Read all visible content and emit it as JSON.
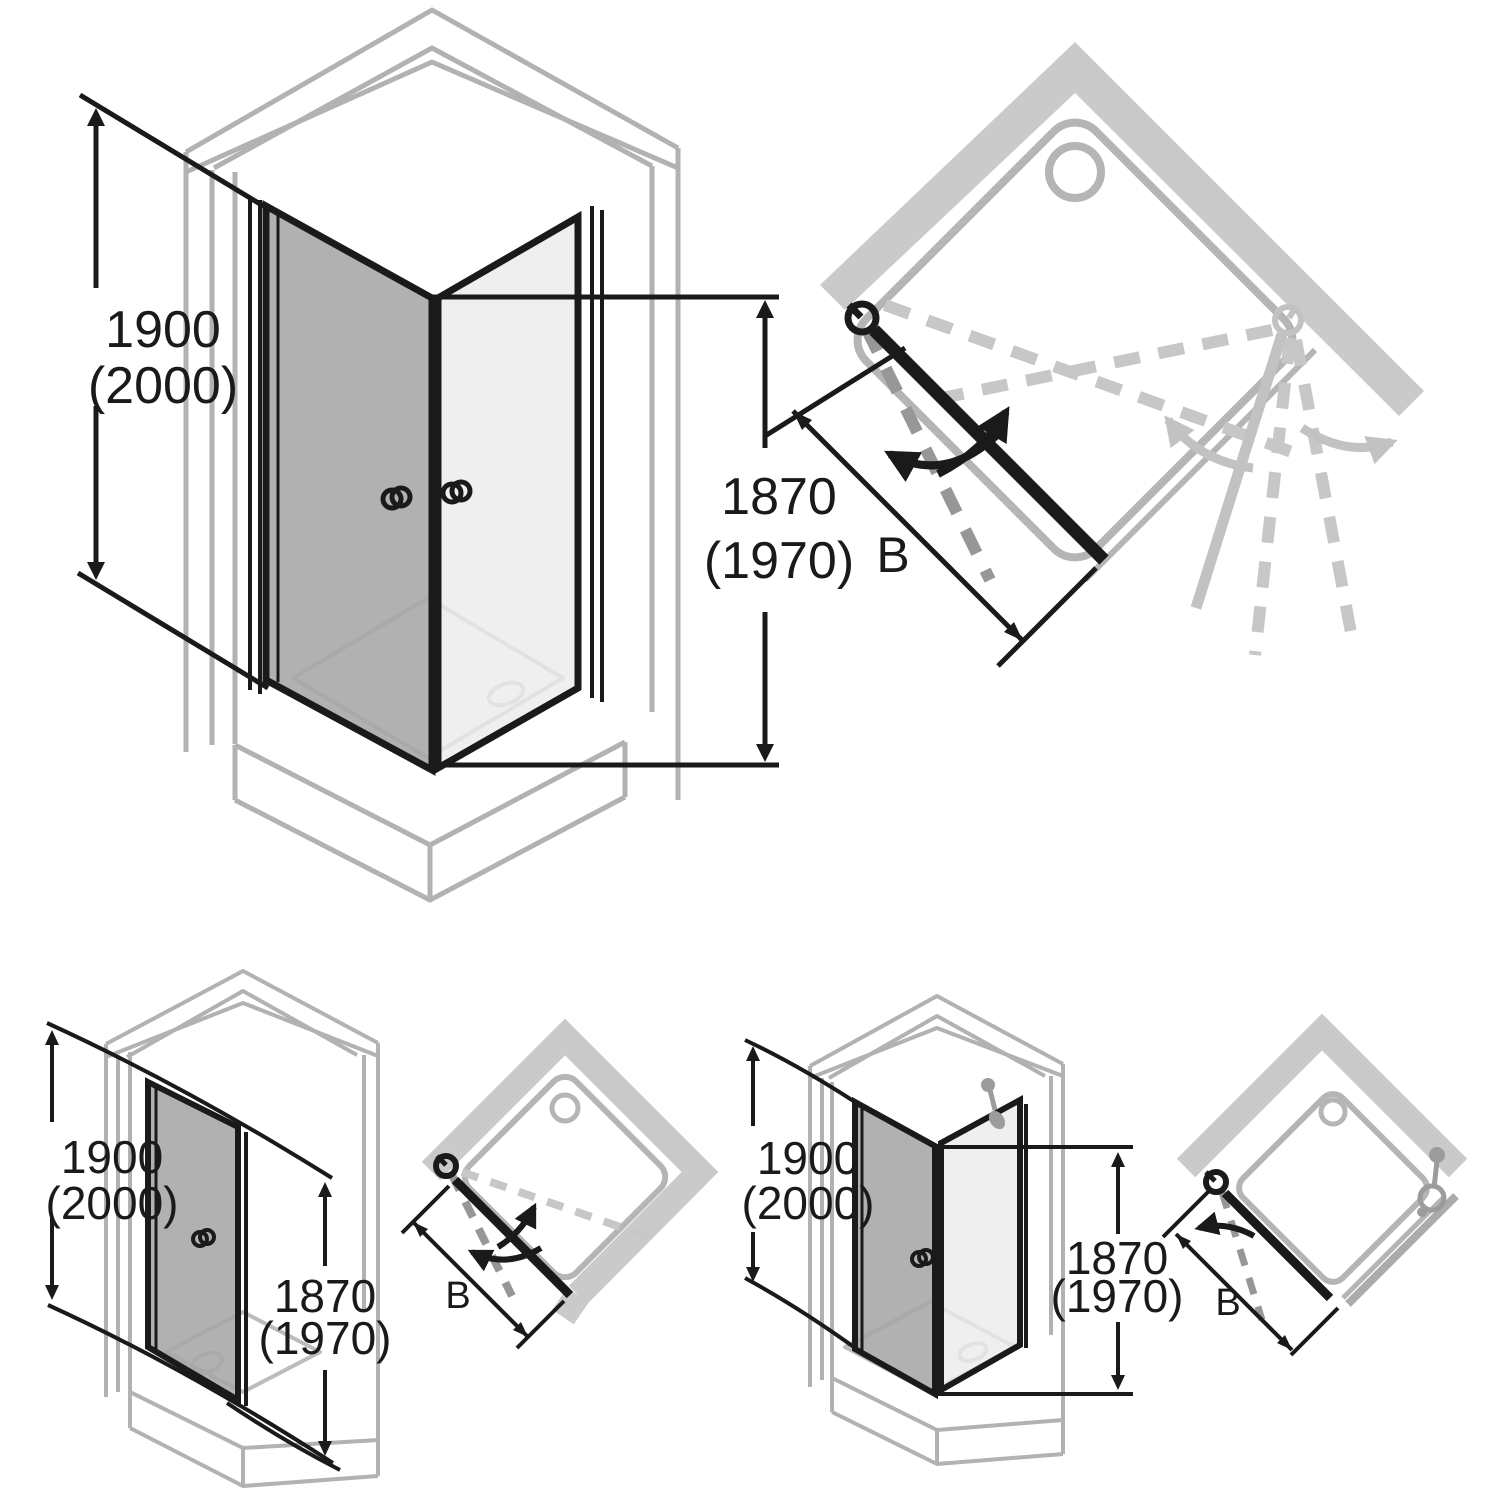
{
  "colors": {
    "background": "#ffffff",
    "ink": "#1a1a1a",
    "ghost_outline": "#b2b2b2",
    "tray_outline": "#b5b5b5",
    "wall_fill": "#cacaca",
    "door_dark": "#a6a6a6",
    "glass_light": "#ebebeb",
    "dash_dark": "#979797",
    "dash_light": "#c7c7c7",
    "ghost_door": "#c2c2c2",
    "fixture_gray": "#9c9c9c"
  },
  "figures": {
    "corner_iso": {
      "height": "1900",
      "height_alt": "(2000)",
      "door_height": "1870",
      "door_height_alt": "(1970)"
    },
    "corner_plan": {
      "width_label": "B"
    },
    "niche_iso": {
      "height": "1900",
      "height_alt": "(2000)",
      "door_height": "1870",
      "door_height_alt": "(1970)"
    },
    "niche_plan": {
      "width_label": "B"
    },
    "panel_iso": {
      "height": "1900",
      "height_alt": "(2000)",
      "door_height": "1870",
      "door_height_alt": "(1970)"
    },
    "panel_plan": {
      "width_label": "B"
    }
  }
}
